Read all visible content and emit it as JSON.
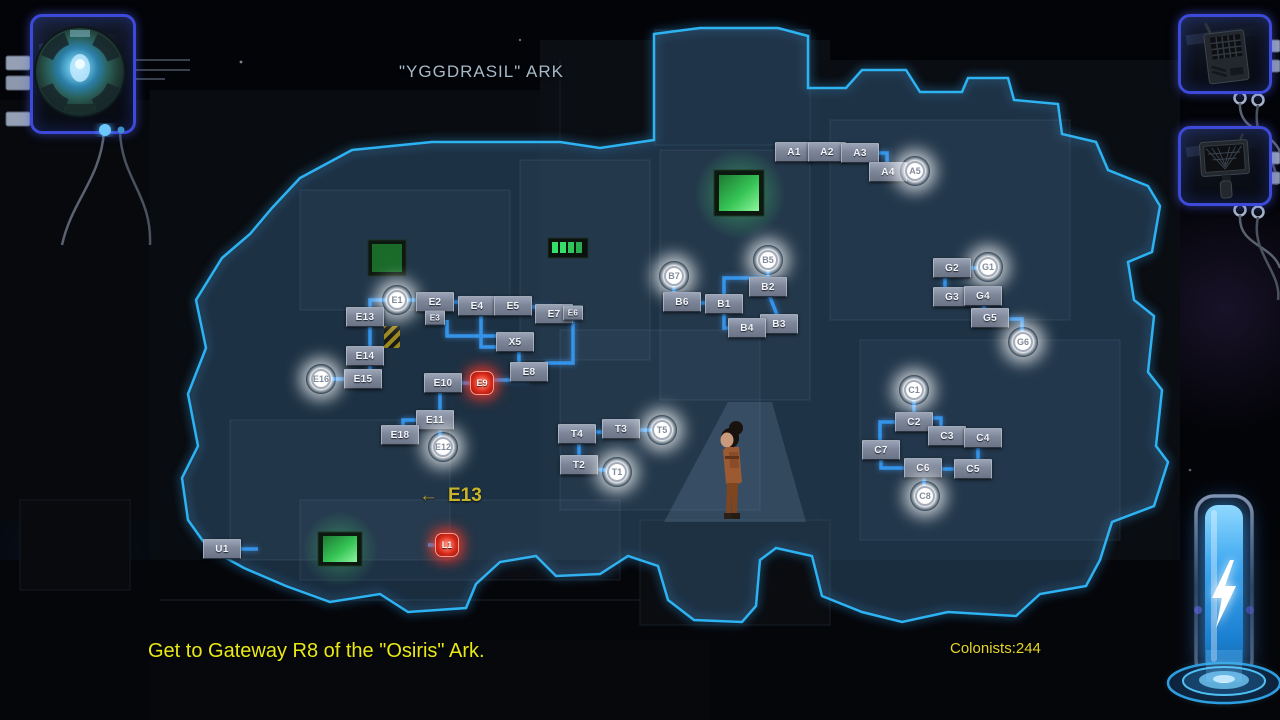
{
  "map": {
    "title": "\"YGGDRASIL\" ARK",
    "sign": {
      "arrow": "←",
      "label": "E13"
    },
    "nodes": [
      {
        "id": "A1",
        "x": 794,
        "y": 152,
        "t": "box"
      },
      {
        "id": "A2",
        "x": 827,
        "y": 152,
        "t": "box"
      },
      {
        "id": "A3",
        "x": 860,
        "y": 153,
        "t": "box"
      },
      {
        "id": "A4",
        "x": 888,
        "y": 172,
        "t": "box"
      },
      {
        "id": "A5",
        "x": 915,
        "y": 171,
        "t": "gateway"
      },
      {
        "id": "B5",
        "x": 768,
        "y": 260,
        "t": "gateway"
      },
      {
        "id": "B7",
        "x": 674,
        "y": 276,
        "t": "gateway"
      },
      {
        "id": "B2",
        "x": 768,
        "y": 287,
        "t": "box"
      },
      {
        "id": "B6",
        "x": 682,
        "y": 302,
        "t": "box"
      },
      {
        "id": "B1",
        "x": 724,
        "y": 304,
        "t": "box"
      },
      {
        "id": "B3",
        "x": 779,
        "y": 324,
        "t": "box"
      },
      {
        "id": "B4",
        "x": 747,
        "y": 328,
        "t": "box"
      },
      {
        "id": "G1",
        "x": 988,
        "y": 267,
        "t": "gateway"
      },
      {
        "id": "G2",
        "x": 952,
        "y": 268,
        "t": "box"
      },
      {
        "id": "G3",
        "x": 952,
        "y": 297,
        "t": "box"
      },
      {
        "id": "G4",
        "x": 983,
        "y": 296,
        "t": "box"
      },
      {
        "id": "G5",
        "x": 990,
        "y": 318,
        "t": "box"
      },
      {
        "id": "G6",
        "x": 1023,
        "y": 342,
        "t": "gateway"
      },
      {
        "id": "E1",
        "x": 397,
        "y": 300,
        "t": "gateway"
      },
      {
        "id": "E2",
        "x": 435,
        "y": 302,
        "t": "box"
      },
      {
        "id": "E3",
        "x": 435,
        "y": 318,
        "t": "box",
        "small": true
      },
      {
        "id": "E13",
        "x": 365,
        "y": 317,
        "t": "box"
      },
      {
        "id": "E14",
        "x": 365,
        "y": 356,
        "t": "box"
      },
      {
        "id": "E15",
        "x": 363,
        "y": 379,
        "t": "box"
      },
      {
        "id": "E16",
        "x": 321,
        "y": 379,
        "t": "gateway"
      },
      {
        "id": "E4",
        "x": 477,
        "y": 306,
        "t": "box"
      },
      {
        "id": "E5",
        "x": 513,
        "y": 306,
        "t": "box"
      },
      {
        "id": "E7",
        "x": 554,
        "y": 314,
        "t": "box"
      },
      {
        "id": "E6",
        "x": 573,
        "y": 313,
        "t": "box",
        "small": true
      },
      {
        "id": "X5",
        "x": 515,
        "y": 342,
        "t": "box"
      },
      {
        "id": "E8",
        "x": 529,
        "y": 372,
        "t": "box"
      },
      {
        "id": "E9",
        "x": 482,
        "y": 383,
        "t": "alert"
      },
      {
        "id": "E10",
        "x": 443,
        "y": 383,
        "t": "box"
      },
      {
        "id": "E11",
        "x": 435,
        "y": 420,
        "t": "box"
      },
      {
        "id": "E18",
        "x": 400,
        "y": 435,
        "t": "box"
      },
      {
        "id": "E12",
        "x": 443,
        "y": 447,
        "t": "gateway"
      },
      {
        "id": "T4",
        "x": 577,
        "y": 434,
        "t": "box"
      },
      {
        "id": "T3",
        "x": 621,
        "y": 429,
        "t": "box"
      },
      {
        "id": "T5",
        "x": 662,
        "y": 430,
        "t": "gateway"
      },
      {
        "id": "T2",
        "x": 579,
        "y": 465,
        "t": "box"
      },
      {
        "id": "T1",
        "x": 617,
        "y": 472,
        "t": "gateway"
      },
      {
        "id": "C1",
        "x": 914,
        "y": 390,
        "t": "gateway"
      },
      {
        "id": "C2",
        "x": 914,
        "y": 422,
        "t": "box"
      },
      {
        "id": "C3",
        "x": 947,
        "y": 436,
        "t": "box"
      },
      {
        "id": "C4",
        "x": 983,
        "y": 438,
        "t": "box"
      },
      {
        "id": "C7",
        "x": 881,
        "y": 450,
        "t": "box"
      },
      {
        "id": "C6",
        "x": 923,
        "y": 468,
        "t": "box"
      },
      {
        "id": "C5",
        "x": 973,
        "y": 469,
        "t": "box"
      },
      {
        "id": "C8",
        "x": 925,
        "y": 496,
        "t": "gateway"
      },
      {
        "id": "U1",
        "x": 222,
        "y": 549,
        "t": "box"
      },
      {
        "id": "L1",
        "x": 447,
        "y": 545,
        "t": "alert"
      }
    ],
    "edges": [
      [
        794,
        152,
        860,
        152
      ],
      [
        860,
        153,
        887,
        153,
        887,
        172
      ],
      [
        887,
        172,
        915,
        172
      ],
      [
        674,
        278,
        674,
        302
      ],
      [
        682,
        303,
        724,
        303
      ],
      [
        724,
        304,
        724,
        278,
        768,
        278
      ],
      [
        768,
        278,
        768,
        260
      ],
      [
        768,
        292,
        779,
        320
      ],
      [
        724,
        304,
        724,
        328,
        747,
        328
      ],
      [
        747,
        328,
        779,
        326
      ],
      [
        952,
        268,
        988,
        268
      ],
      [
        945,
        270,
        945,
        297
      ],
      [
        952,
        297,
        983,
        297
      ],
      [
        984,
        296,
        984,
        316,
        990,
        316
      ],
      [
        996,
        319,
        1022,
        319,
        1022,
        342
      ],
      [
        397,
        300,
        435,
        300
      ],
      [
        397,
        300,
        370,
        300,
        370,
        379
      ],
      [
        363,
        379,
        321,
        379
      ],
      [
        435,
        302,
        477,
        302
      ],
      [
        435,
        306,
        435,
        318
      ],
      [
        447,
        320,
        447,
        336,
        502,
        336
      ],
      [
        481,
        310,
        481,
        347,
        500,
        347
      ],
      [
        477,
        306,
        513,
        306
      ],
      [
        513,
        306,
        554,
        308
      ],
      [
        554,
        314,
        573,
        314
      ],
      [
        573,
        318,
        573,
        363,
        545,
        363
      ],
      [
        519,
        348,
        519,
        366
      ],
      [
        529,
        380,
        482,
        380
      ],
      [
        443,
        383,
        482,
        383
      ],
      [
        440,
        387,
        440,
        414
      ],
      [
        430,
        420,
        403,
        420,
        403,
        428
      ],
      [
        440,
        430,
        440,
        447
      ],
      [
        577,
        432,
        621,
        432
      ],
      [
        621,
        430,
        662,
        430
      ],
      [
        579,
        438,
        579,
        465
      ],
      [
        579,
        468,
        617,
        471
      ],
      [
        914,
        393,
        914,
        413
      ],
      [
        920,
        418,
        941,
        418,
        941,
        428
      ],
      [
        947,
        437,
        983,
        437
      ],
      [
        978,
        443,
        978,
        467
      ],
      [
        973,
        469,
        923,
        469
      ],
      [
        924,
        476,
        924,
        492
      ],
      [
        906,
        422,
        880,
        422,
        880,
        442
      ],
      [
        881,
        456,
        881,
        468,
        908,
        468
      ],
      [
        232,
        549,
        258,
        549
      ],
      [
        428,
        545,
        447,
        545
      ]
    ],
    "colors": {
      "edge": "#3494ea",
      "border": "#2db3f2",
      "reveal_fill": "rgba(108,138,178,0.16)",
      "node_box": "#8a93a4",
      "gateway_glow": "#ffffff",
      "alert_red": "#dd2d1d",
      "annotation_yellow": "#c9b52b",
      "objective_yellow": "#e9e915"
    }
  },
  "hud": {
    "objective": "Get to Gateway R8 of the \"Osiris\" Ark.",
    "colonists": "Colonists:244",
    "icons": {
      "top_left": "ark-core-icon",
      "top_right_1": "radio-transmitter-icon",
      "top_right_2": "handheld-scanner-icon",
      "bottom_right": "energy-reserve-icon"
    }
  }
}
